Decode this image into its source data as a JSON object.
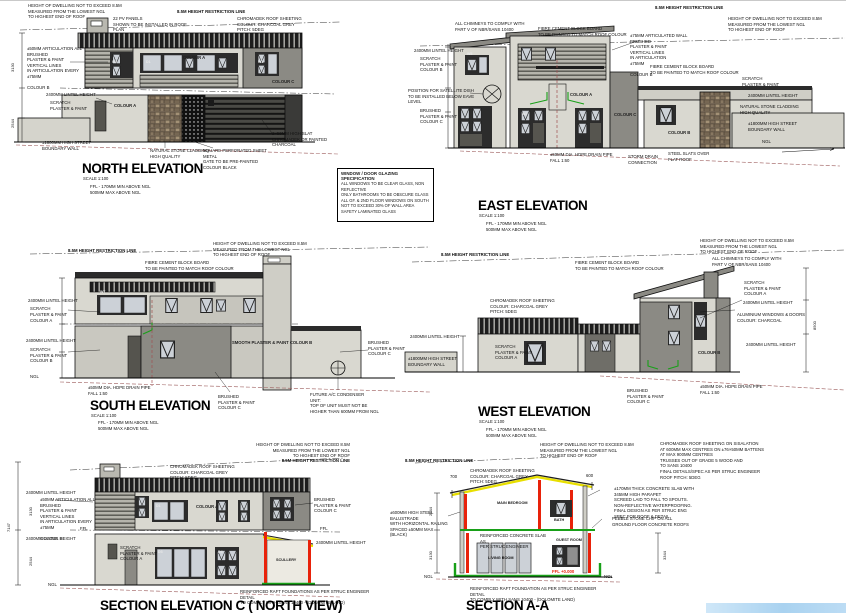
{
  "colors": {
    "charcoal_roof": "#1d1d1d",
    "wall_light": "#d9d8d0",
    "wall_mid": "#b9b8b0",
    "wall_dark": "#8b8a84",
    "stone": "#94846f",
    "accent_red": "#e8220a",
    "accent_green": "#18a018",
    "accent_yellow": "#e8df00",
    "drain_line": "#9b5a5a",
    "sky_strip": "#a9d2f0"
  },
  "shared": {
    "height_note": "HEIGHT OF DWELLING NOT TO EXCEED 8.5M\nMEASURED FROM THE LOWEST NGL\nTO HIGHEST END OF ROOF",
    "restriction": "8.5M HEIGHT RESTRICTION LINE",
    "chromadek": "CHROMADEK ROOF SHEETING\nCOLOUR: CHARCOAL GREY\nPITCH: 5DEG",
    "fibre": "FIBRE CEMENT BLOCK BOARD\nTO BE PAINTED TO MATCH ROOF COLOUR",
    "chimneys": "ALL CHIMNEYS TO COMPLY WITH\nPART V OF NBR/SANS 10400",
    "lintel": "2400MM LINTEL HEIGHT",
    "scratch": "SCRATCH\nPLASTER & PAINT",
    "scratch_a": "SCRATCH\nPLASTER & PAINT\nCOLOUR A",
    "scratch_b": "SCRATCH\nPLASTER & PAINT\nCOLOUR B",
    "brushed_c": "BRUSHED\nPLASTER & PAINT\nCOLOUR C",
    "street_wall": "±1800MM HIGH STREET\nBOUNDARY WALL",
    "drain": "±50MM DIA. HDPE DRAIN PIPE\nFALL 1:60",
    "ffl_note": "FFL - 170MM MIN ABOVE NGL\n500MM MAX ABOVE NGL",
    "scale": "SCALE 1:100",
    "ffl": "FFL",
    "ngl": "NGL",
    "colour_a": "COLOUR A",
    "colour_b": "COLOUR B",
    "colour_c": "COLOUR C"
  },
  "tags": {
    "w1": "W1",
    "w2": "W2",
    "w5": "W5",
    "w7": "W7",
    "d1": "D1",
    "d3": "D3",
    "d4": "D4"
  },
  "north": {
    "title": "NORTH ELEVATION",
    "pv": "22 PV PANELS\nSHOWN TO BE INSTALLED IN ROOF\nPLAN",
    "articulation": "±50MM ARTICULATION ALL\nBRUSHED\nPLASTER & PAINT\nVERTICAL LINES\nIN ARTICULATION EVERY\n±75MM\n\nCOLOUR B",
    "stone": "NATURAL STONE CLADDING\nHIGH QUALITY",
    "gate": "SQUARE PERFORATED SHEET METAL\nGATE TO BE PRE-PAINTED\nCOLOUR BLACK",
    "slat": "2×50MM HIGH SLAT\nCHROMADEK OR PAINTED\nCHARCOAL",
    "dim_upper": "3130",
    "dim_lower": "2544"
  },
  "east": {
    "title": "EAST ELEVATION",
    "satellite": "POSITION FOR SATELLITE DISH\nTO BE INSTALLED BELOW EAVE LEVEL",
    "articulated75": "±75MM ARTICULATED WALL\nBRUSHED\nPLASTER & PAINT\nVERTICAL LINES\nIN ARTICULATION\n±75MM\n\nCOLOUR B",
    "stone": "NATURAL STONE CLADDING\nHIGH QUALITY",
    "storm": "STORM DRAIN\nCONNECTION",
    "slats_over": "STEEL SLATS OVER\nFLAT ROOF"
  },
  "south": {
    "title": "SOUTH ELEVATION",
    "smooth_b": "SMOOTH\nPLASTER & PAINT\nCOLOUR B",
    "ac_unit": "FUTURE A/C CONDENSER\nUNIT:\nTOP OF UNIT MUST NOT BE\nHIGHER THAN 600MM FROM NGL"
  },
  "west": {
    "title": "WEST ELEVATION",
    "aluminium": "ALUMINIUM WINDOWS & DOORS\nCOLOUR: CHARCOAL",
    "dim_8500": "8500"
  },
  "sectionC": {
    "title": "SECTION ELEVATION C ( NORTH VIEW)",
    "scullery": "SCULLERY",
    "raft": "REINFORCED RAFT FOUNDATIONS AS PER STRUC ENGINEER DETAIL\nTO COMPLY WITH SANS 10400 - (DOLOMITE LAND)",
    "dim_total": "7147",
    "dim_upper": "3130",
    "dim_lower": "2544"
  },
  "sectionA": {
    "title": "SECTION A-A",
    "room_main": "MAIN BEDROOM",
    "room_bath": "BATH",
    "room_guest": "GUEST ROOM",
    "room_living": "LIVING ROOM",
    "balustrade": "±600MM HIGH STEEL BALUSTRADE\nWITH HORIZONTAL RAILING\nSPACED ±50MM MAX\n(BLACK)",
    "roof_note": "CHROMADEK ROOF SHEETING ON SISALATION\nAT 600MM MAX CENTRES ON ±76×50MM BATTENS\nAT MAX 900MM CENTRES\nTRUSSES OUT OF GRADE 5 WOOD AND\nTO SANS 10400\nFINAL DETAILS/SPEC AS PER STRUC ENGINEER",
    "pitch": "ROOF PITCH: 5DEG",
    "slab_note": "±170MM THICK CONCRETE SLAB WITH\n345MM HIGH PARAPET\nSCREED LAID TO FALL TO SPOUTS.\nNON-REFLECTIVE WATERPROOFING.\nFINAL DESIGN AS PER STRUC ENG\nSPEC FOR ROOF & DETAIL",
    "pebble": "PEBBLE STONE CHIP ON ALL\nGROUND FLOOR CONCRETE ROOFS",
    "slab": "REINFORCED CONCRETE SLAB AS\nPER STRUC ENGINEER",
    "raft": "REINFORCED RAFT FOUNDATION AS PER STRUC ENGINEER DETAIL\nTO COMPLY WITH SANS 10400 - (DOLOMITE LAND)",
    "ffl_zero": "FFL +0.000",
    "dim_left_eave": "700",
    "dim_right_eave": "600",
    "dim_upper": "2544",
    "dim_lower": "3130",
    "dim_right": "3344"
  },
  "glazing": {
    "title": "WINDOW / DOOR GLAZING SPECIFICATION",
    "body": "ALL WINDOWS TO BE CLEAR GLASS, NON REFLECTIVE\nONLY BATHROOMS TO BE OBSCURE GLASS\nALL GF. & 2ND FLOOR WINDOWS ON SOUTH\nNOT TO EXCEED 30% OF WALL AREA\nSAFETY LAMINATED GLASS"
  }
}
